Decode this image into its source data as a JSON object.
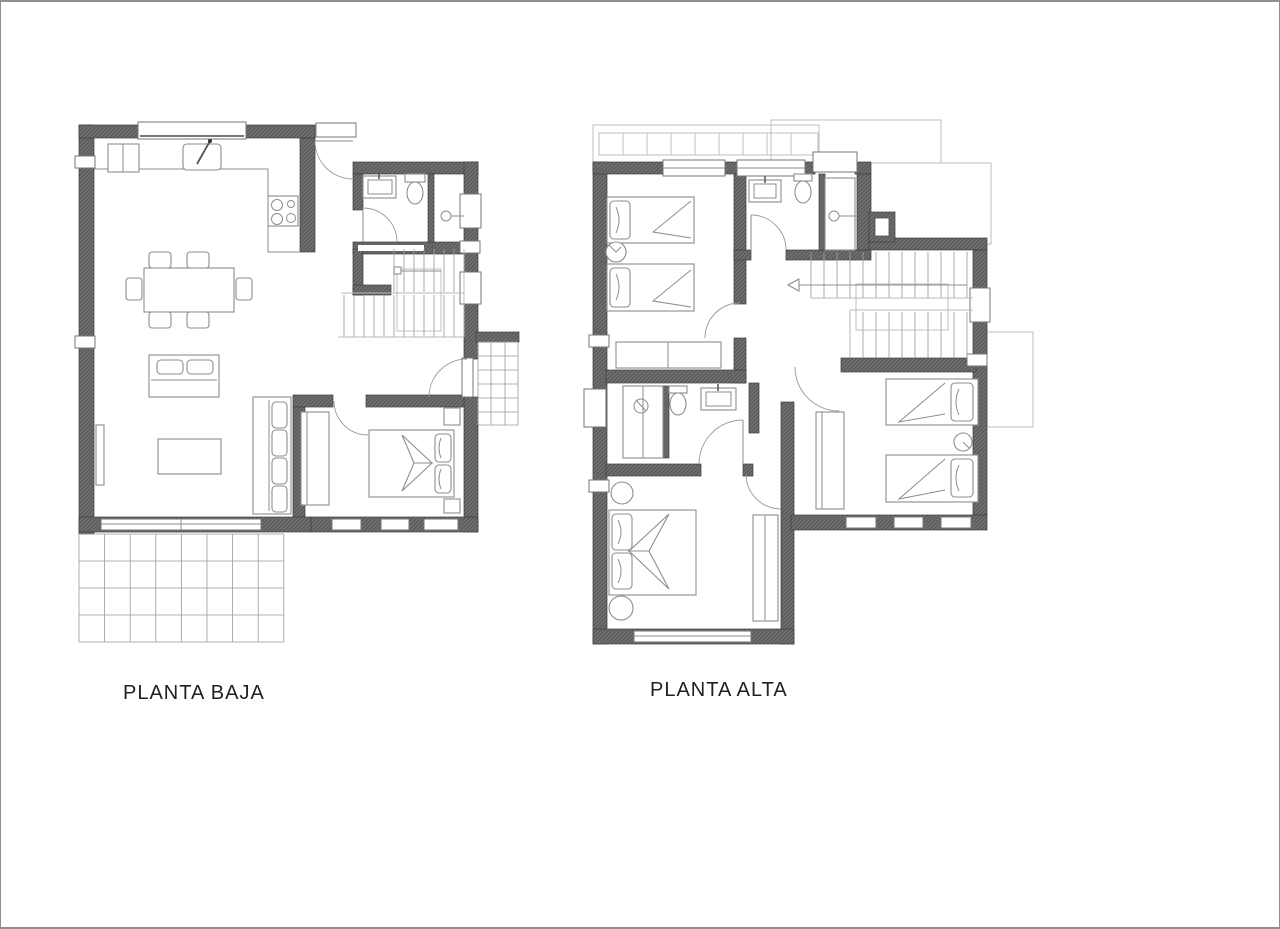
{
  "page": {
    "width": 1280,
    "height": 929,
    "background": "#ffffff"
  },
  "colors": {
    "background": "#ffffff",
    "frame_line": "#8f8f8f",
    "wall": "#6f6f6f",
    "wall_edge": "#3e3e3e",
    "furniture_line": "#8d8d8d",
    "light_line": "#b9b9b9",
    "window_frame": "#767676",
    "text": "#212121"
  },
  "plans": [
    {
      "title": "PLANTA BAJA",
      "rooms": [
        "living-dining",
        "kitchen",
        "bathroom",
        "bedroom",
        "hall-stairs",
        "terrace",
        "porch"
      ],
      "symbols": [
        "dining-table",
        "chair",
        "sofa",
        "coffee-table",
        "radiator",
        "kitchen-counter",
        "kitchen-sink",
        "hob",
        "bathroom-sink",
        "toilet",
        "shower-head",
        "stairs",
        "double-bed",
        "wardrobe",
        "nightstand",
        "terrace-tiles",
        "door-arc",
        "window"
      ]
    },
    {
      "title": "PLANTA ALTA",
      "rooms": [
        "twin-bedroom-left",
        "bathroom-top",
        "shower-room",
        "stairs-landing",
        "bathroom-middle",
        "master-bedroom",
        "twin-bedroom-right"
      ],
      "symbols": [
        "single-bed",
        "double-bed",
        "pillow",
        "wardrobe",
        "clock-table",
        "bathroom-sink",
        "toilet",
        "shower",
        "stairs",
        "direction-arrow",
        "roof-outline",
        "pergola",
        "door-arc",
        "window"
      ]
    }
  ]
}
